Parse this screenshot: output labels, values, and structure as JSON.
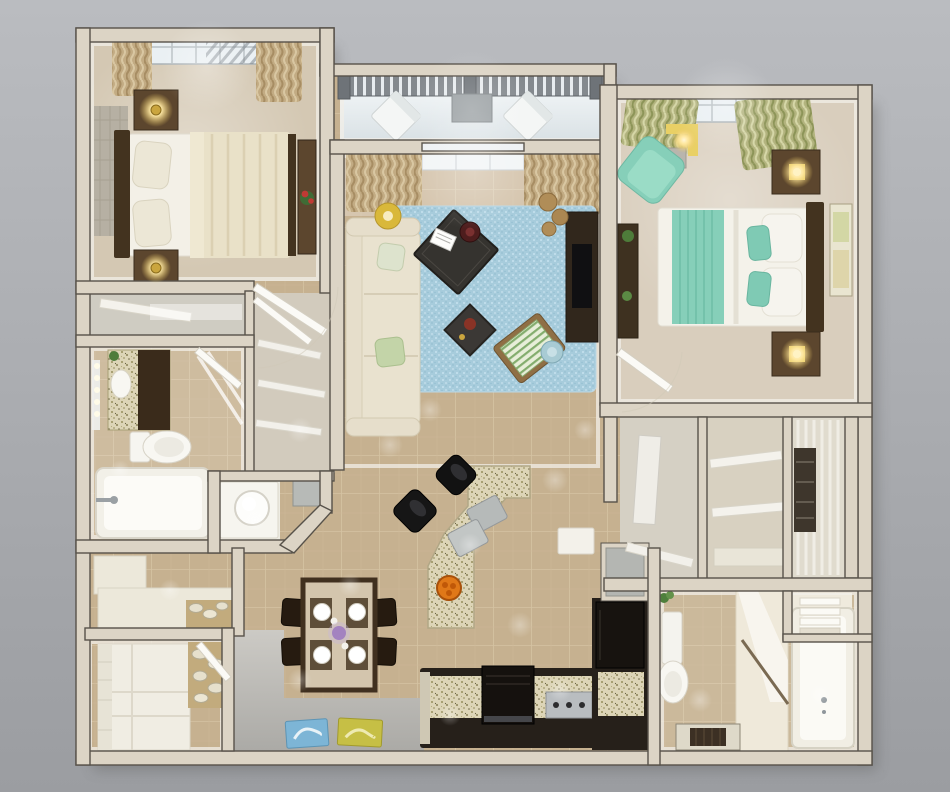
{
  "scene": {
    "title": "3D rendered floor plan of a two-bedroom apartment, top-down view",
    "rooms": [
      {
        "name": "bedroom-1",
        "furniture": [
          "double bed with cream duvet",
          "dark headboard",
          "two nightstands with lit lamps",
          "patterned area rug",
          "dresser with red flowers",
          "skylight window with tan curtains"
        ]
      },
      {
        "name": "balcony",
        "furniture": [
          "gray railing",
          "two white chairs",
          "balcony door"
        ]
      },
      {
        "name": "living-room",
        "furniture": [
          "cream sofa with pillows",
          "dark square coffee table with magazine and red bowl",
          "small side table",
          "green striped lounge chair",
          "light blue area rug",
          "yellow drum floor lamp",
          "tv console",
          "window with tan curtains",
          "round baskets"
        ]
      },
      {
        "name": "bedroom-2",
        "furniture": [
          "double bed with white and teal bedding",
          "dark headboard",
          "two nightstands with lit lamps",
          "teal armchair",
          "yellow table lamp",
          "dresser with plants",
          "wall art",
          "window with green curtains"
        ]
      },
      {
        "name": "bathroom-1",
        "furniture": [
          "vanity with granite top",
          "mirror lights",
          "toilet",
          "bathtub",
          "glass shower panel"
        ]
      },
      {
        "name": "wc-niche",
        "furniture": [
          "round white basin",
          "gray floor mat"
        ]
      },
      {
        "name": "hall-closets",
        "furniture": [
          "shelved closet",
          "wardrobe with door"
        ]
      },
      {
        "name": "kitchen",
        "furniture": [
          "angled granite island with two sinks",
          "two black bar stools",
          "orange fruit bowl",
          "dark cabinets",
          "stove",
          "cooktop with knobs",
          "refrigerator",
          "gray counter"
        ]
      },
      {
        "name": "dining-area",
        "furniture": [
          "dark wood table",
          "four chairs",
          "four place settings",
          "purple flower centerpiece"
        ]
      },
      {
        "name": "laundry-storage",
        "furniture": [
          "white cabinets",
          "white counter",
          "pebble floor decor"
        ]
      },
      {
        "name": "walk-in-closets",
        "furniture": [
          "white shelves",
          "hanging clothes",
          "towel stacks"
        ]
      },
      {
        "name": "bathroom-2",
        "furniture": [
          "toilet",
          "vanity",
          "bathtub",
          "dark floor mat",
          "towel shelves",
          "plant"
        ]
      },
      {
        "name": "entry",
        "furniture": [
          "blue doormat",
          "yellow doormat",
          "gray floor"
        ]
      }
    ]
  },
  "palette": {
    "bg-top": "#babcc0",
    "bg-bottom": "#9b9da1",
    "wall": "#dcd4c5",
    "wall-line": "#57524a",
    "wall-face": "#f2efe8",
    "tile": "#c6b190",
    "tile-line": "#d5c3a3",
    "carpet1": "#d4c8b3",
    "carpet2": "#d9cebd",
    "rug-blue": "#a7ccdc",
    "balcony-floor": "#edf1f3",
    "railing": "#84898e",
    "sofa": "#e6decb",
    "wood-dark": "#43331f",
    "wood-mid": "#5c462e",
    "counter-dark": "#26201a",
    "granite": "#ddd5b7",
    "steel": "#b9bdc0",
    "teal": "#86cfb9",
    "duvet": "#e9e1c8",
    "glow": "#ffe9a4",
    "gray-floor": "#c4c2bd",
    "mat-blue": "#7db5d6",
    "mat-yellow": "#c6bf45",
    "door-white": "#fbfaf6"
  }
}
